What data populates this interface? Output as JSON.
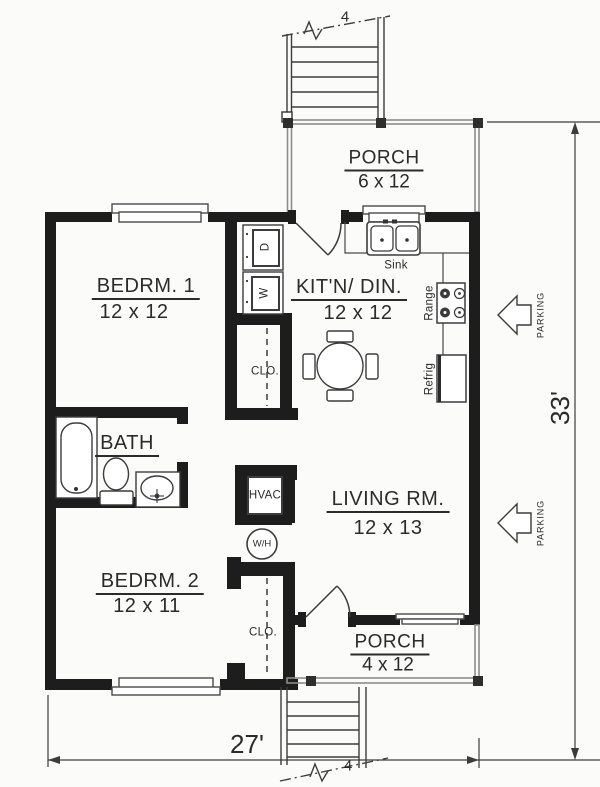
{
  "title": "Two-bedroom house floor plan",
  "colors": {
    "wall": "#1d1d1d",
    "line": "#3c3c3c",
    "porch": "#8d8d8d",
    "text": "#2b2b2b",
    "bg": "#fbfbfa"
  },
  "rooms": {
    "porch_top": {
      "name": "PORCH",
      "size": "6 x 12"
    },
    "bedroom1": {
      "name": "BEDRM. 1",
      "size": "12 x 12"
    },
    "kitchen": {
      "name": "KIT'N/ DIN.",
      "size": "12 x 12"
    },
    "bath": {
      "name": "BATH"
    },
    "living": {
      "name": "LIVING RM.",
      "size": "12 x 13"
    },
    "bedroom2": {
      "name": "BEDRM. 2",
      "size": "12 x 11"
    },
    "porch_bottom": {
      "name": "PORCH",
      "size": "4 x 12"
    }
  },
  "fixtures": {
    "sink": "Sink",
    "range": "Range",
    "refrigerator": "Refrig",
    "dryer": "D",
    "washer": "W",
    "hvac": "HVAC",
    "water_heater": "W/H",
    "closet_upper": "CLO.",
    "closet_lower": "CLO."
  },
  "dimensions": {
    "overall_width": "27'",
    "overall_height": "33'",
    "stair_width_top": "4",
    "stair_width_bottom": "4"
  },
  "site": {
    "parking_upper": "PARKING",
    "parking_lower": "PARKING"
  }
}
